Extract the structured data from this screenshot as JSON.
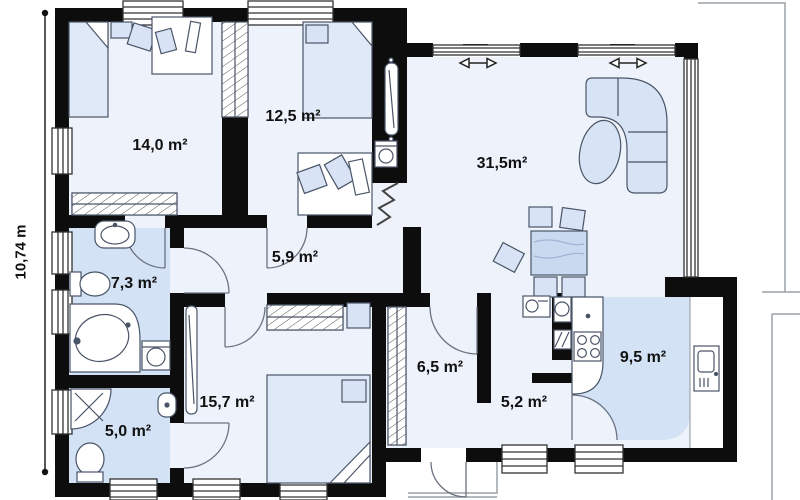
{
  "dimension_label": "10,74 m",
  "rooms": [
    {
      "id": "bedroom-1",
      "area": "14,0 m²"
    },
    {
      "id": "bedroom-2",
      "area": "12,5 m²"
    },
    {
      "id": "living-room",
      "area": "31,5m²"
    },
    {
      "id": "hallway",
      "area": "5,9 m²"
    },
    {
      "id": "bathroom",
      "area": "7,3 m²"
    },
    {
      "id": "wc",
      "area": "5,0 m²"
    },
    {
      "id": "bedroom-3",
      "area": "15,7 m²"
    },
    {
      "id": "entry-hall",
      "area": "6,5 m²"
    },
    {
      "id": "corridor",
      "area": "5,2 m²"
    },
    {
      "id": "kitchen",
      "area": "9,5 m²"
    }
  ],
  "colors": {
    "wall": "#0d0d0d",
    "room_fill": "#eef3fb",
    "wet_room_fill": "#d3e2f4",
    "furniture_fill": "#d8e4f5",
    "background": "#ffffff"
  }
}
